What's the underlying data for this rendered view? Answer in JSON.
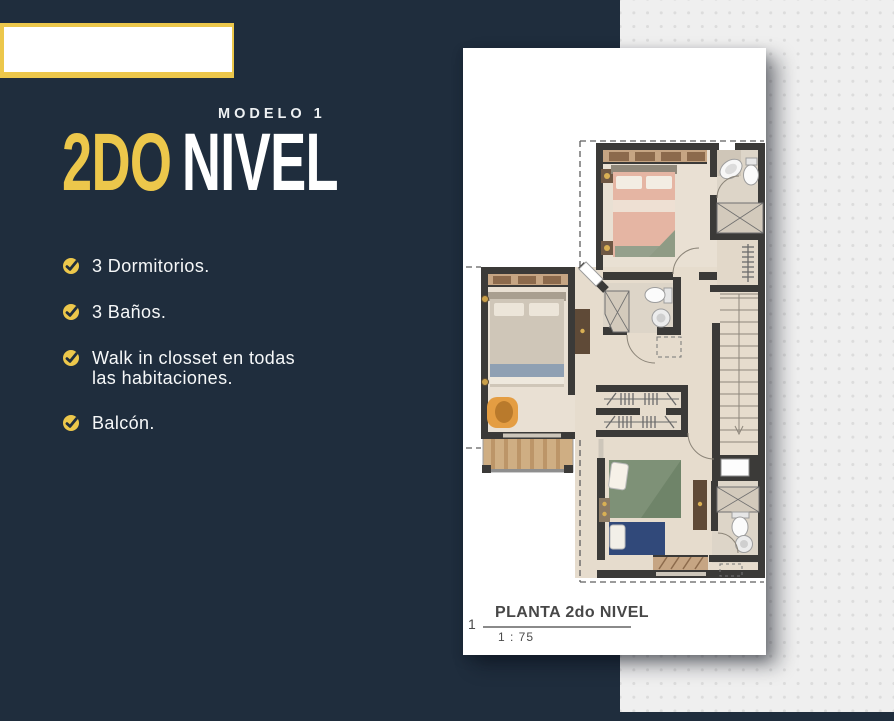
{
  "colors": {
    "background_navy": "#1f2d3d",
    "accent_yellow": "#ecc74b",
    "panel_gray": "#efefef",
    "text_light": "#f6f8f9"
  },
  "header": {
    "eyebrow": "MODELO 1",
    "title_accent": "2DO",
    "title_rest": "NIVEL"
  },
  "features": [
    {
      "label": "3 Dormitorios."
    },
    {
      "label": "3 Baños."
    },
    {
      "label": "Walk in closset en todas las habitaciones."
    },
    {
      "label": "Balcón."
    }
  ],
  "plan": {
    "figure_number": "1",
    "caption": "PLANTA 2do NIVEL",
    "scale": "1 : 75"
  }
}
